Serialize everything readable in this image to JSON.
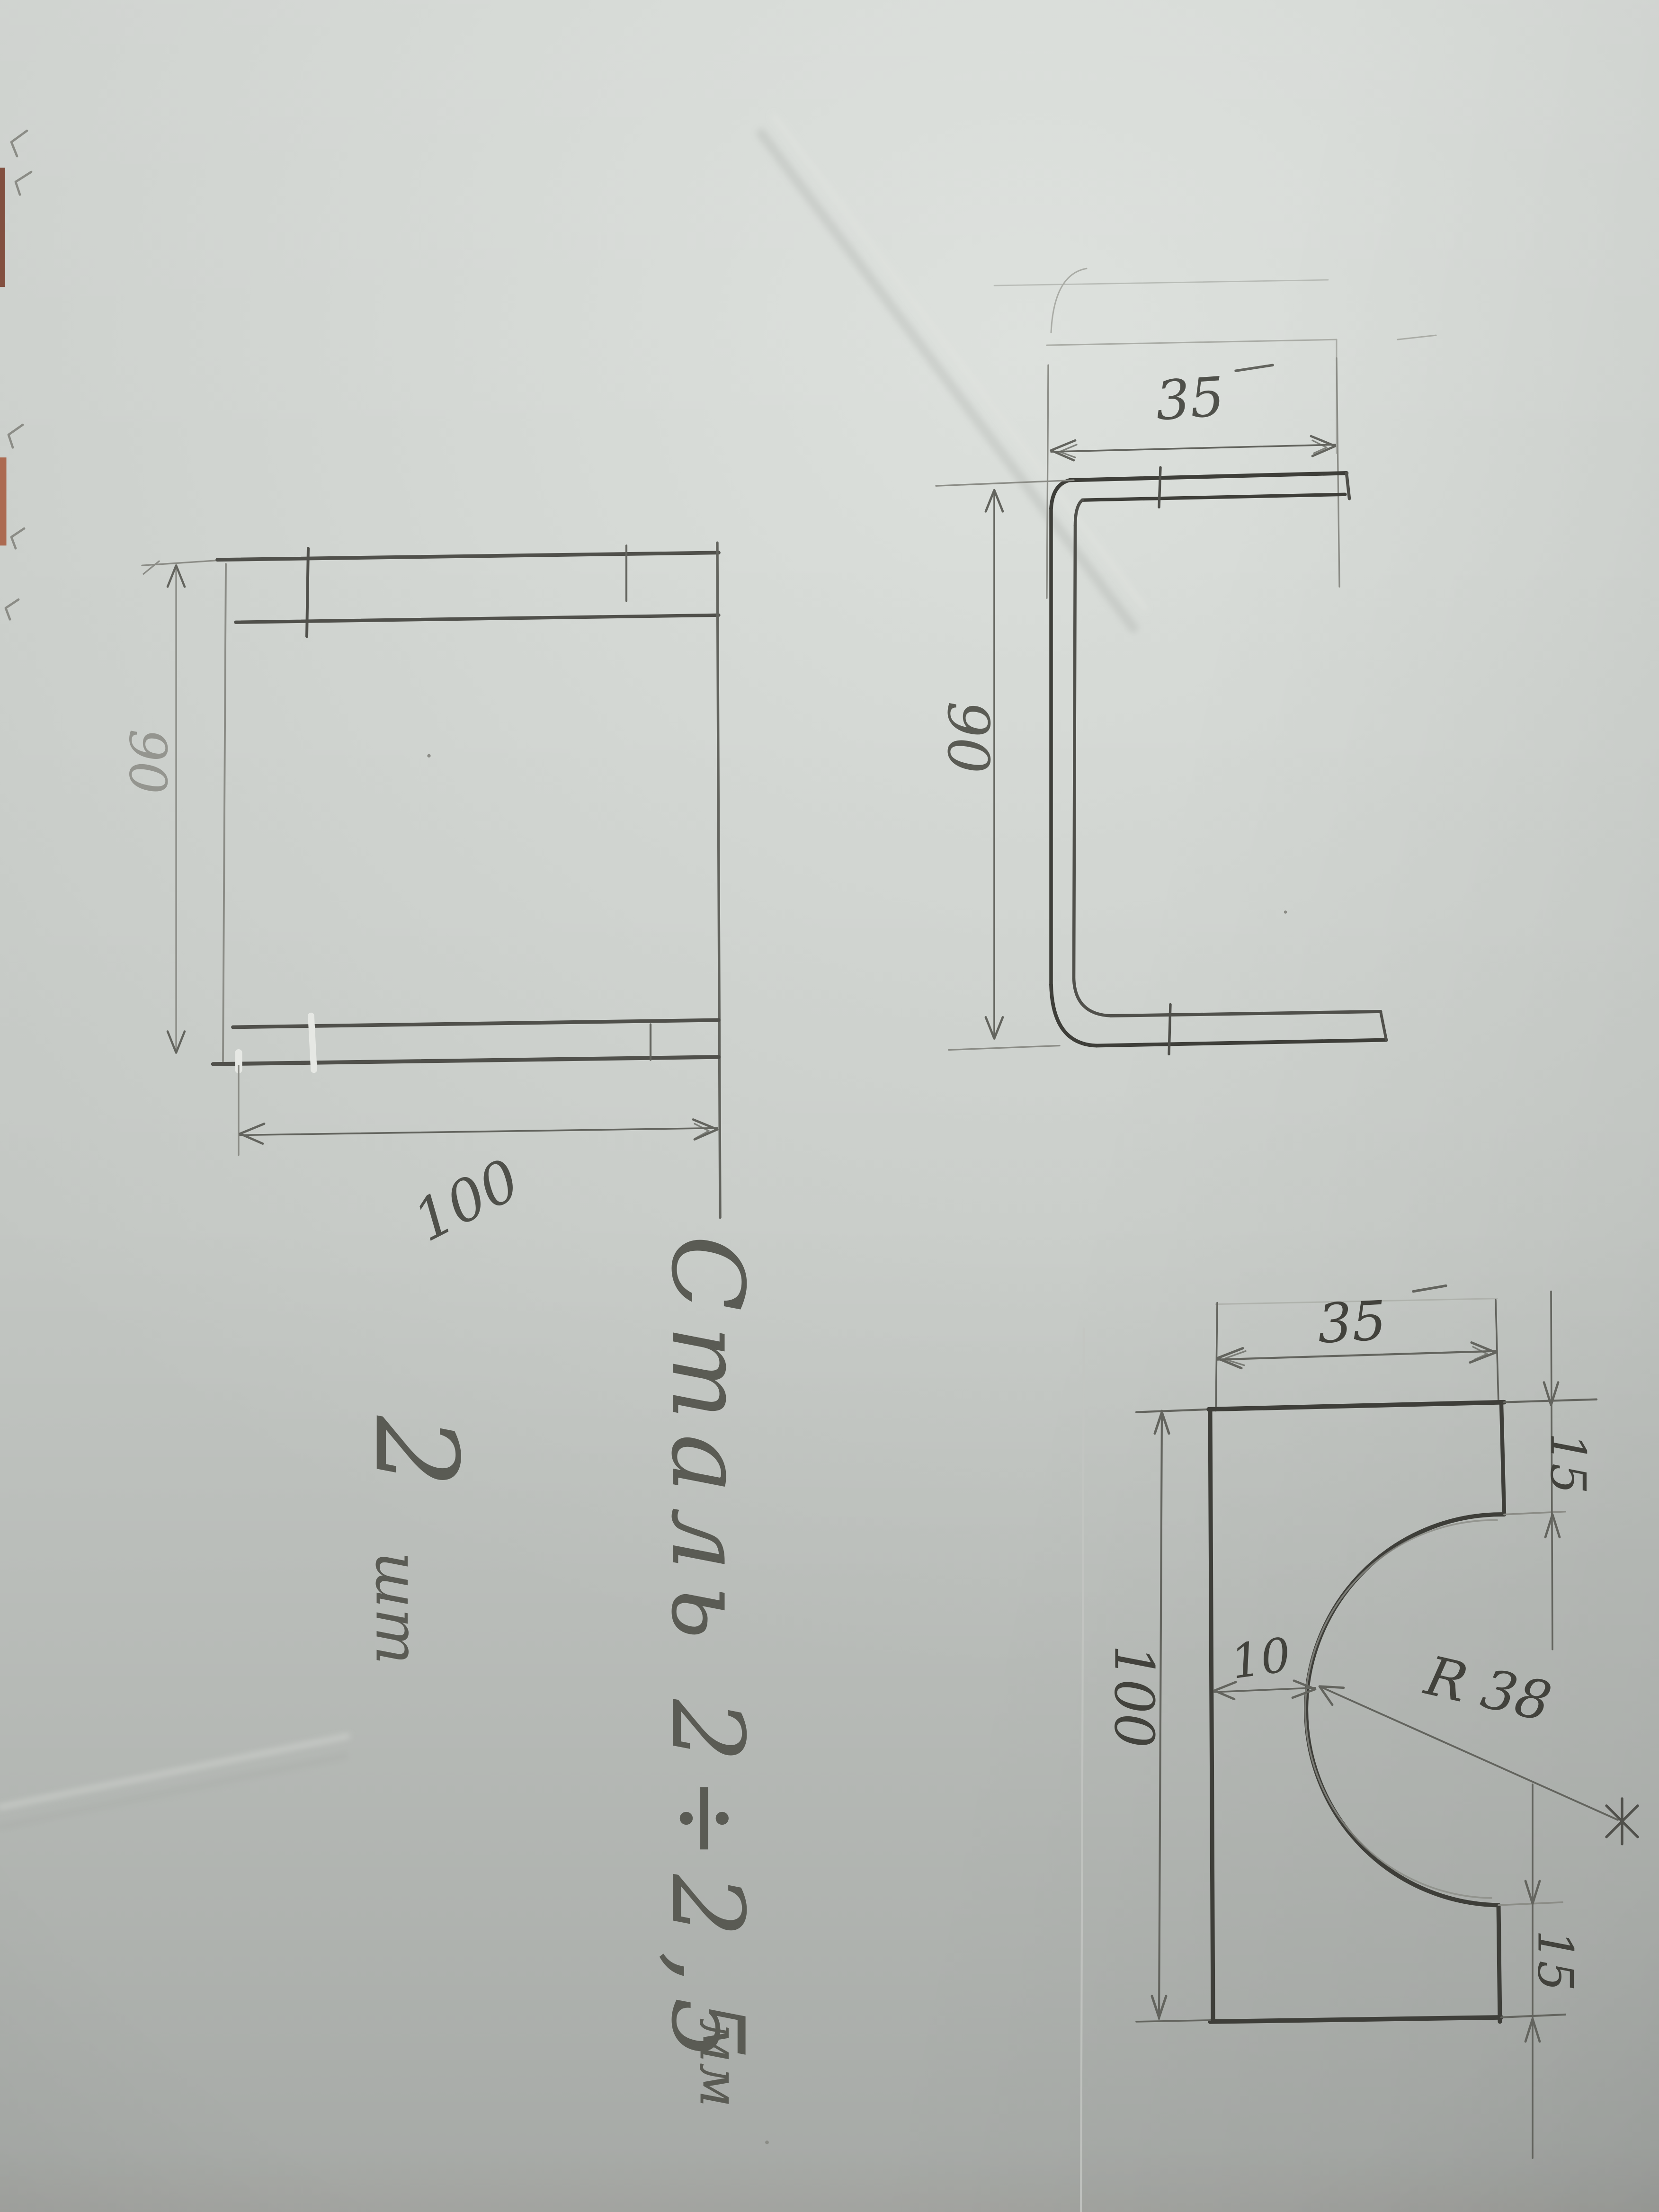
{
  "views": {
    "front": {
      "height_label": "90",
      "width_label": "100"
    },
    "profile": {
      "flange_label": "35",
      "height_label": "90"
    },
    "pattern": {
      "width_label": "35",
      "tab_top_label": "15",
      "height_label": "100",
      "offset_label": "10",
      "radius_label": "R 38",
      "tab_bottom_label": "15"
    }
  },
  "notes": {
    "material": "Сталь 2÷2,5",
    "material_unit": "мм",
    "quantity": "2",
    "quantity_unit": "шт"
  },
  "colors": {
    "paper": "#c7cbc7",
    "ink-dark": "#3e3e39",
    "ink": "#50504b",
    "ink-med": "#63645e",
    "ink-light": "#8b8c86",
    "ink-faint": "#aaaca6",
    "label": "#4f504a",
    "label-dark": "#42423c",
    "label-mid": "#5a5b54",
    "label-faint": "#94958f",
    "white-fix": "#e6e8e4",
    "table-edge": "#8f4c36",
    "crease-light": "#e2e4e0",
    "crease-dark": "#9da09c",
    "crease-mid": "#c3c6c2"
  }
}
